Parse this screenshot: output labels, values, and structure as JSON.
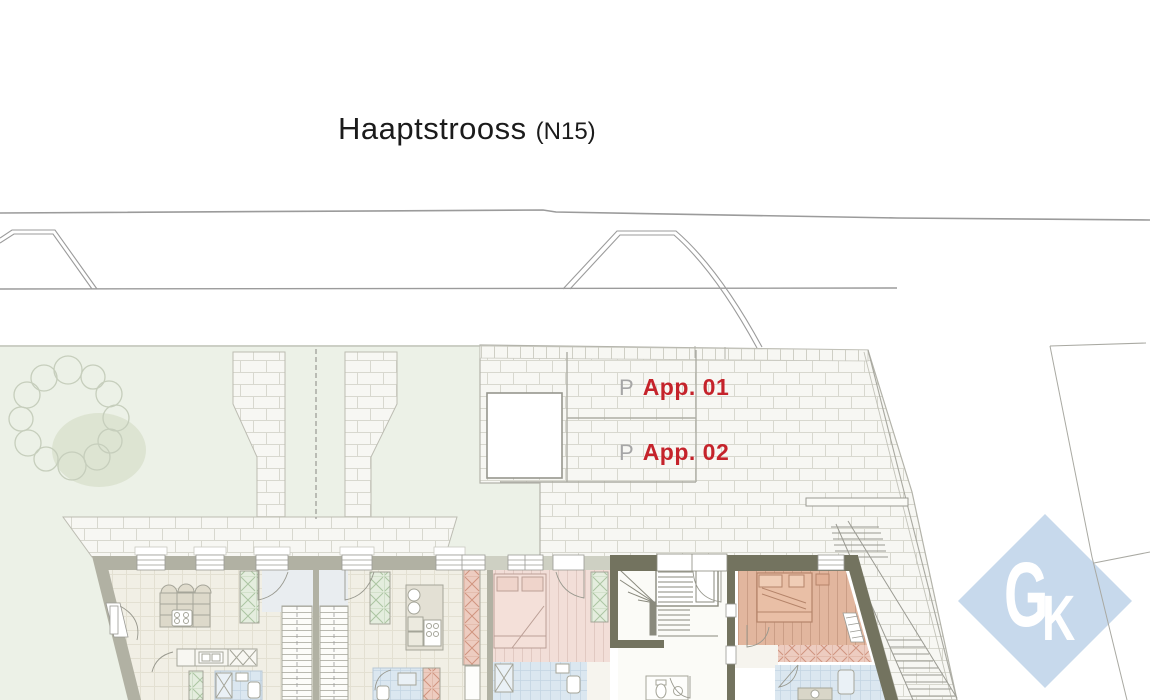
{
  "title": {
    "street": "Haaptstrooss",
    "reference": "(N15)"
  },
  "parking": {
    "spots": [
      {
        "marker": "P",
        "label": "App. 01"
      },
      {
        "marker": "P",
        "label": "App. 02"
      }
    ]
  },
  "logo": {
    "text": "GK",
    "letters": [
      "G",
      "K"
    ]
  },
  "colors": {
    "accent_red": "#c5232b",
    "marker_gray": "#a6a6a6",
    "logo_blue": "#c7d9ec",
    "lawn_green": "#ecf1e7",
    "tree_shadow": "#dde4d2",
    "paving_white": "#f7f7f3",
    "brick_joint": "#d8d8cf",
    "wall_dark": "#73735f",
    "wall_medium": "#b1b1a3",
    "wall_light": "#ced0c3",
    "floor_cream": "#f2f0e7",
    "bath_blue": "#dbe7f0",
    "bedroom_rose": "#f2ded8",
    "bedroom_salmon": "#e2b69e",
    "closet_green": "#e4edde",
    "tile_pink": "#edccc0"
  }
}
